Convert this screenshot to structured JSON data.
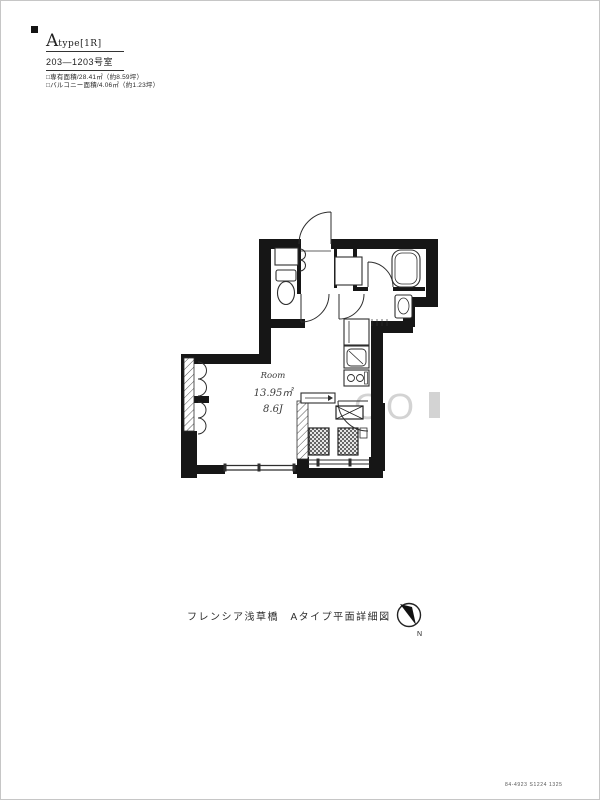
{
  "title_block": {
    "type_main": "A",
    "type_sub": "type[1R]",
    "unit_range": "203—1203号室",
    "area_line1": "□専有面積/28.41㎡（約8.59坪）",
    "area_line2": "□バルコニー面積/4.06㎡（約1.23坪）"
  },
  "plan": {
    "room_label": {
      "name": "Room",
      "area_sqm": "13.95㎡",
      "tatami": "8.6J"
    },
    "watermark": "OO",
    "colors": {
      "wall": "#161616",
      "line": "#2e2e2e",
      "watermark": "#a9a9a9"
    }
  },
  "caption": "フレンシア浅草橋　Aタイプ平面詳細図",
  "compass": {
    "label": "N"
  },
  "footer_code": "84-4923 S1224 1325"
}
